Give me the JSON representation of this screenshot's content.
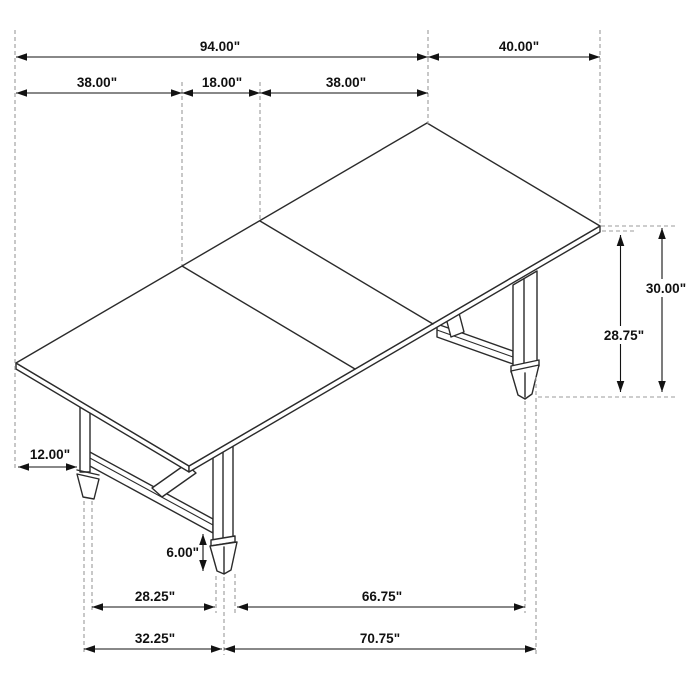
{
  "diagram": {
    "subject": "dining-table-dimension-drawing",
    "unit": "inches",
    "colors": {
      "background": "#ffffff",
      "drawing_line": "#2b2b2b",
      "dimension_line": "#121212",
      "extension_dash": "#9b9b9b",
      "label_text": "#111111"
    },
    "dimensions": {
      "overall_length": "94.00\"",
      "end_extension_width": "40.00\"",
      "left_section": "38.00\"",
      "center_leaf": "18.00\"",
      "right_section": "38.00\"",
      "table_height": "30.00\"",
      "underside_clearance": "28.75\"",
      "leg_inset": "12.00\"",
      "foot_height": "6.00\"",
      "trestle_span_inner": "28.25\"",
      "front_span_inner": "66.75\"",
      "trestle_span_outer": "32.25\"",
      "front_span_outer": "70.75\""
    }
  }
}
